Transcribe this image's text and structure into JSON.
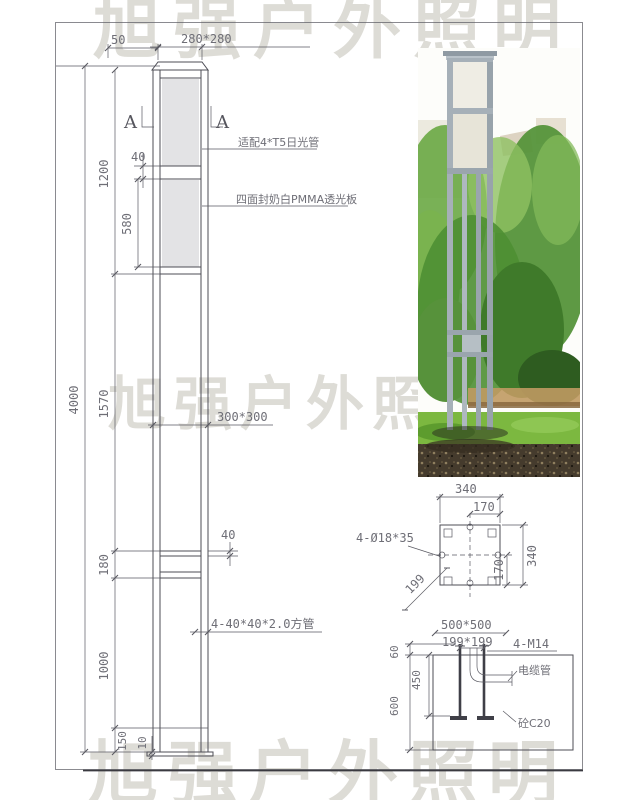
{
  "watermark": {
    "text": "旭强户外照明"
  },
  "colors": {
    "line": "#4d4d55",
    "dim_text": "#6e6e76",
    "panel_fill": "#e3e3e5",
    "watermark": "#d8d6d0"
  },
  "elevation": {
    "dims": {
      "cap_offset": "50",
      "cap_size": "280*280",
      "panel_gap": "40",
      "lantern_height": "1200",
      "panel_height": "580",
      "total_height": "4000",
      "mid_section": "1570",
      "pole_size": "300*300",
      "rail_width": "40",
      "lower_band": "180",
      "tube_spec": "4-40*40*2.0方管",
      "lower_section": "1000",
      "base_section": "150",
      "plate_thickness": "10"
    },
    "annotations": {
      "lamp": "适配4*T5日光管",
      "panel": "四面封奶白PMMA透光板"
    },
    "section_mark": {
      "left": "A",
      "right": "A"
    }
  },
  "plan_detail": {
    "dims": {
      "width_top": "340",
      "half_top": "170",
      "width_right": "340",
      "half_right": "170",
      "bolt_holes": "4-Ø18*35",
      "diagonal": "199"
    }
  },
  "foundation_detail": {
    "dims": {
      "footing": "500*500",
      "bolt_spacing": "199*199",
      "anchor_bolts": "4-M14",
      "projection": "60",
      "embed_depth": "450",
      "footing_depth": "600"
    },
    "annotations": {
      "conduit": "电缆管",
      "concrete": "砼C20"
    }
  }
}
